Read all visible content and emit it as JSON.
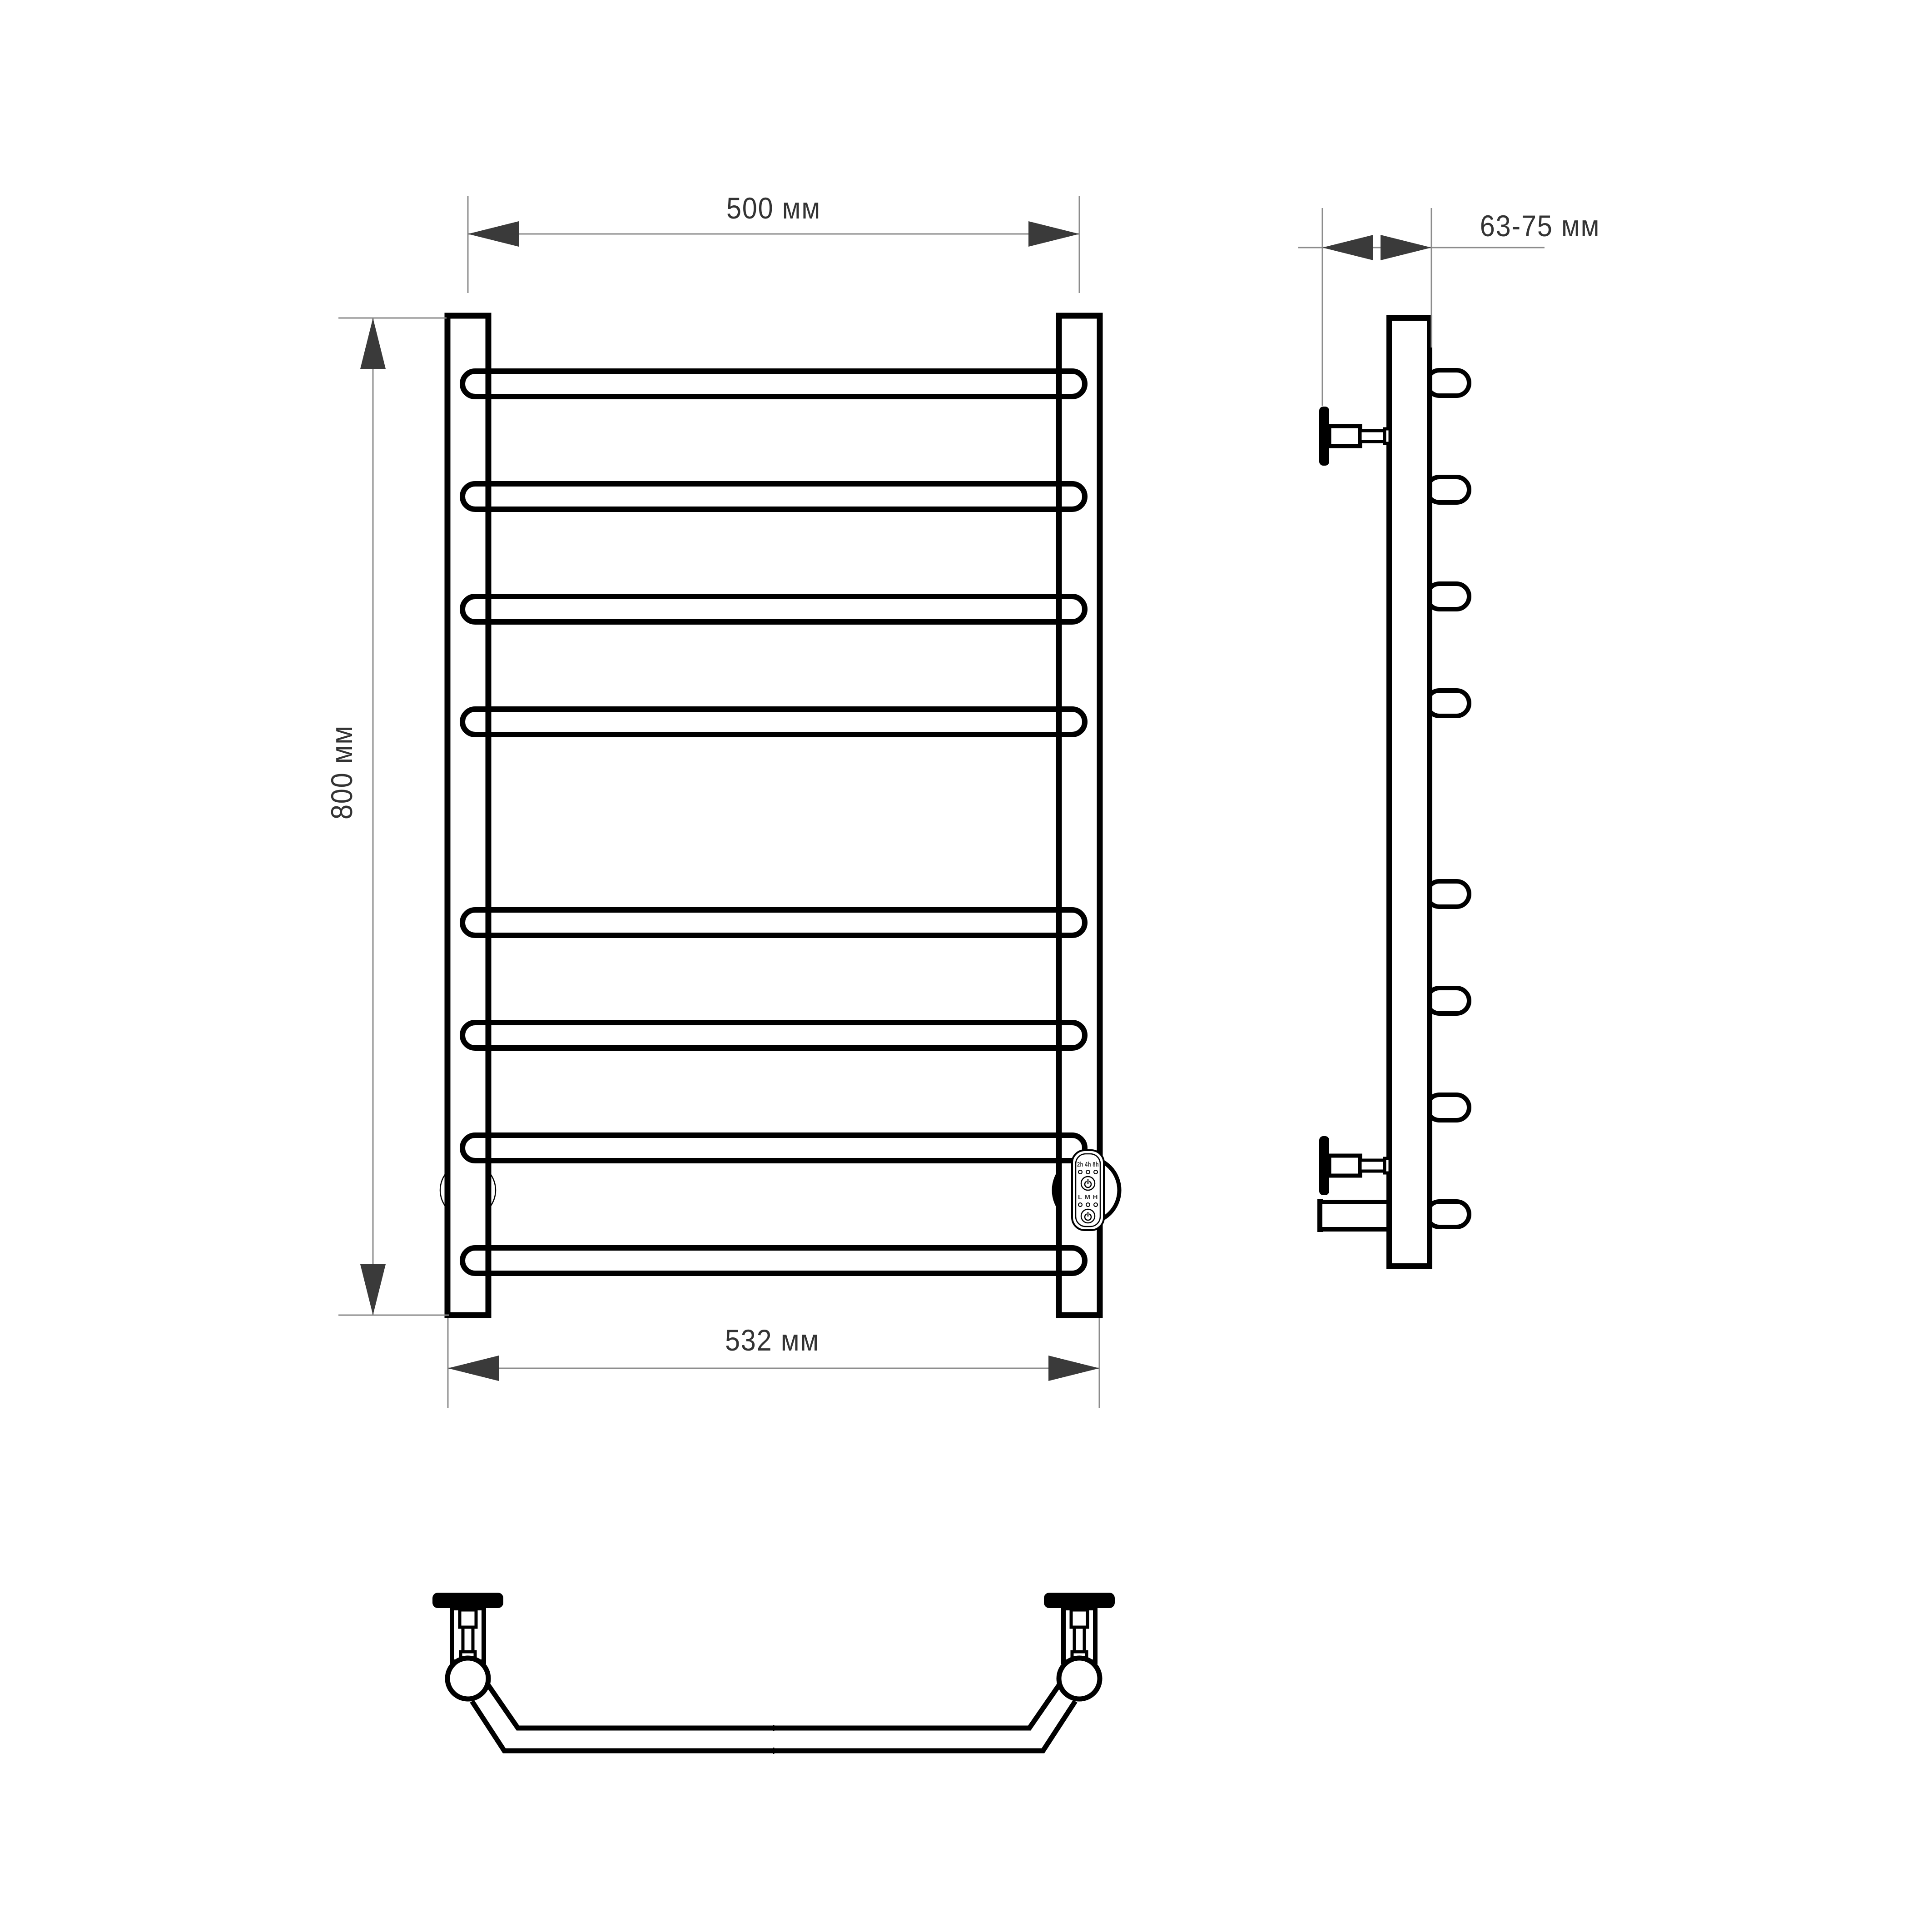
{
  "page": {
    "background": "#ffffff",
    "description_visible_text_only": true
  },
  "colors": {
    "outline": "#000000",
    "dimension_line": "#8c8c8c",
    "arrow": "#3a3a3a",
    "label_text": "#333333",
    "background": "#ffffff",
    "view_fill": "#ffffff"
  },
  "dimensions": {
    "top_width": "500 мм",
    "height": "800 мм",
    "bottom_width": "532 мм",
    "wall_distance": "63-75 мм"
  },
  "control_panel": {
    "timer_labels": "2h 4h 8h",
    "mode_labels": "L M H"
  },
  "icons": {
    "power_button": "power-icon",
    "dimension_arrowhead": "dimension-arrowhead-icon"
  }
}
